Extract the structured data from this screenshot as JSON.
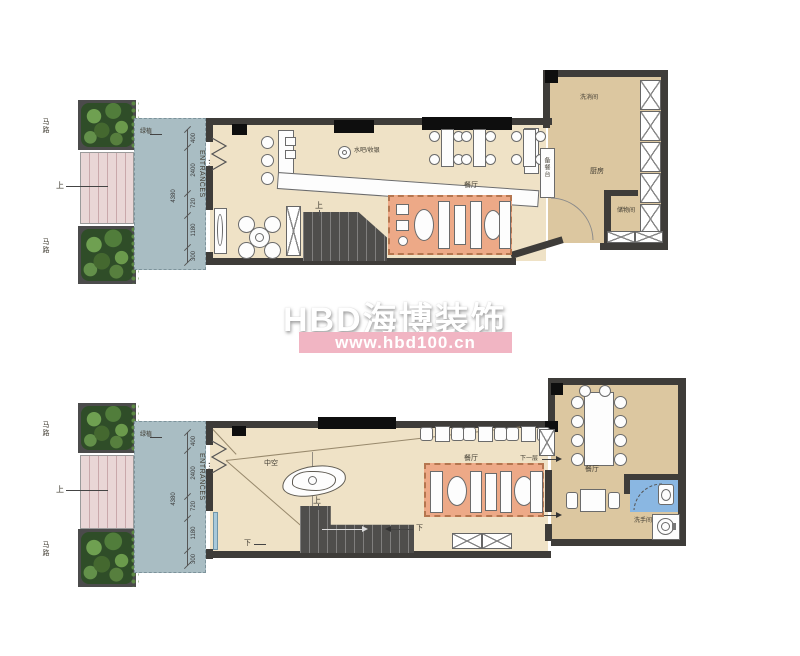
{
  "watermark": {
    "brand": "HBD海博装饰",
    "url": "www.hbd100.cn",
    "bar_color": "#f1b5c3"
  },
  "labels": {
    "road": "马路",
    "up": "上",
    "down": "下",
    "entrance_en": "ENTRANCES",
    "entrance_cn": "主入口",
    "hedge": "绿植",
    "dim_total": "4380",
    "next_floor": "下一层"
  },
  "dims": [
    "400",
    "2400",
    "720",
    "1180",
    "300"
  ],
  "plan1": {
    "rooms": {
      "bar": "水吧/收银",
      "dining": "餐厅",
      "wash": "洗消间",
      "kitchen": "厨房",
      "serving": "备餐台",
      "storage": "储物间"
    }
  },
  "plan2": {
    "rooms": {
      "atrium": "中空",
      "dining": "餐厅",
      "dining2": "餐厅",
      "wc": "洗手间"
    }
  },
  "colors": {
    "wall": "#3e3c39",
    "floor_main": "#efe2c6",
    "floor_kitchen": "#dcc7a0",
    "entrance_plaza": "#a9bdc3",
    "outdoor_stairs": "#e9d6d6",
    "lounge_rug": "#eda987",
    "bathroom_floor": "#8ab7e2",
    "watermark_bar": "#f1b5c3"
  }
}
